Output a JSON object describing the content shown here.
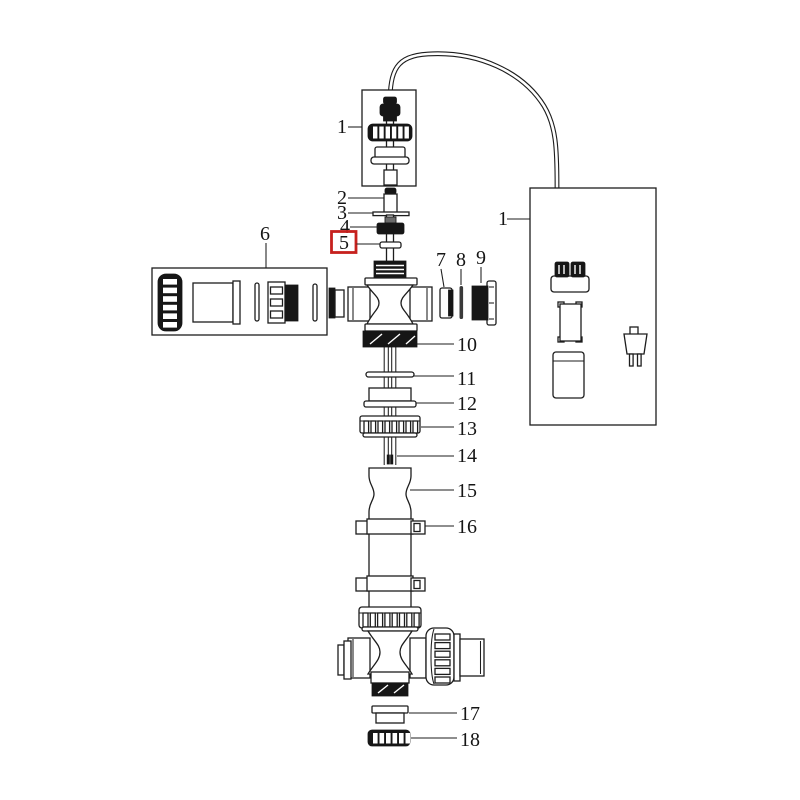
{
  "diagram": {
    "background": "#ffffff",
    "line_color": "#1d1d1d",
    "highlight_color": "#c6211e",
    "labels": {
      "p1_top": "1",
      "p1_right": "1",
      "p2": "2",
      "p3": "3",
      "p4": "4",
      "p5": "5",
      "p6": "6",
      "p7": "7",
      "p8": "8",
      "p9": "9",
      "p10": "10",
      "p11": "11",
      "p12": "12",
      "p13": "13",
      "p14": "14",
      "p15": "15",
      "p16": "16",
      "p17": "17",
      "p18": "18"
    }
  }
}
